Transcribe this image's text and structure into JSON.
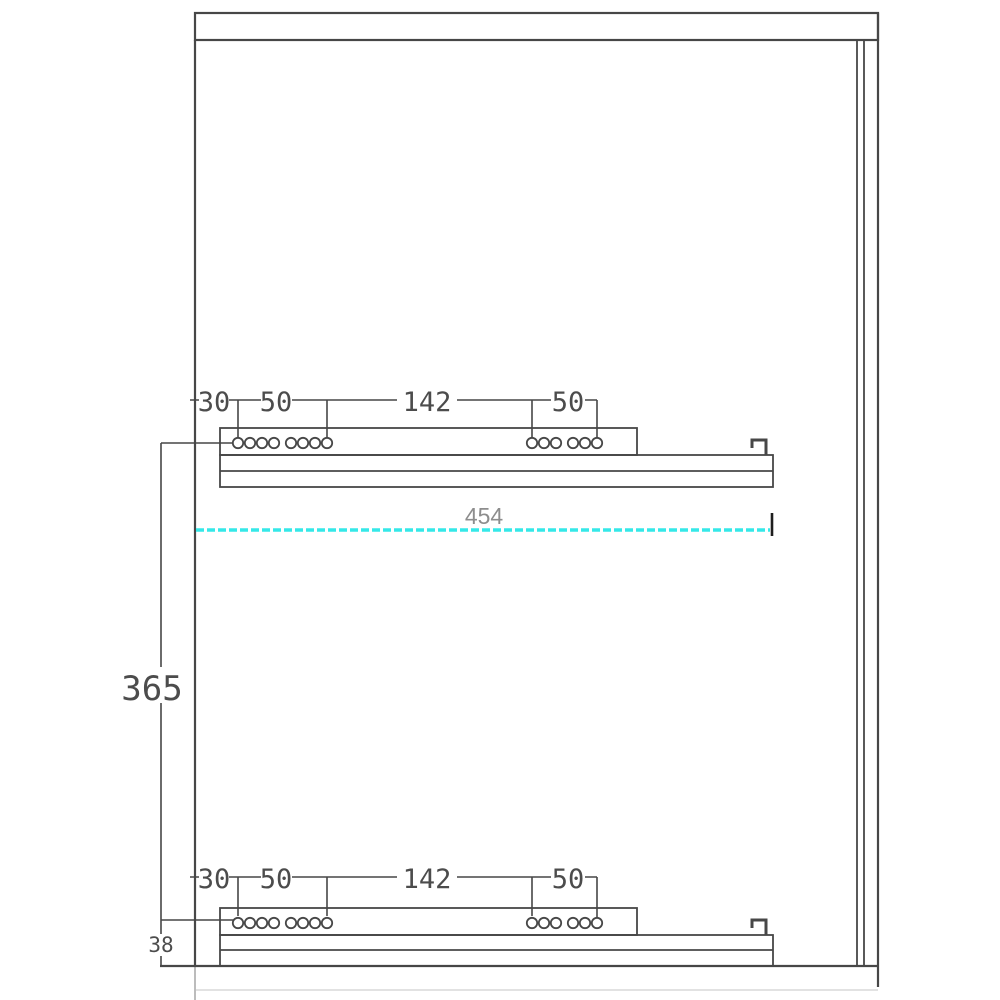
{
  "drawing": {
    "kind": "technical-drawing",
    "description": "Cabinet side panel elevation with two drawer-slide rails and drilling dimensions",
    "colors": {
      "line": "#474747",
      "highlight": "#35e8e8",
      "dim_text": "#4c4c4c",
      "measure_text": "#8d8d8d"
    },
    "top_rail_dims": [
      "30",
      "50",
      "142",
      "50"
    ],
    "bottom_rail_dims": [
      "30",
      "50",
      "142",
      "50"
    ],
    "width_dim": "454",
    "spacing_dim": "365",
    "bottom_offset_dim": "38",
    "hole_pattern": {
      "front_xs": [
        238,
        250,
        262,
        274,
        291,
        303,
        315,
        327
      ],
      "rear_xs": [
        532,
        544,
        556,
        573,
        585,
        597
      ],
      "radius": 5.2,
      "top_y": 443,
      "bottom_y": 923
    }
  }
}
